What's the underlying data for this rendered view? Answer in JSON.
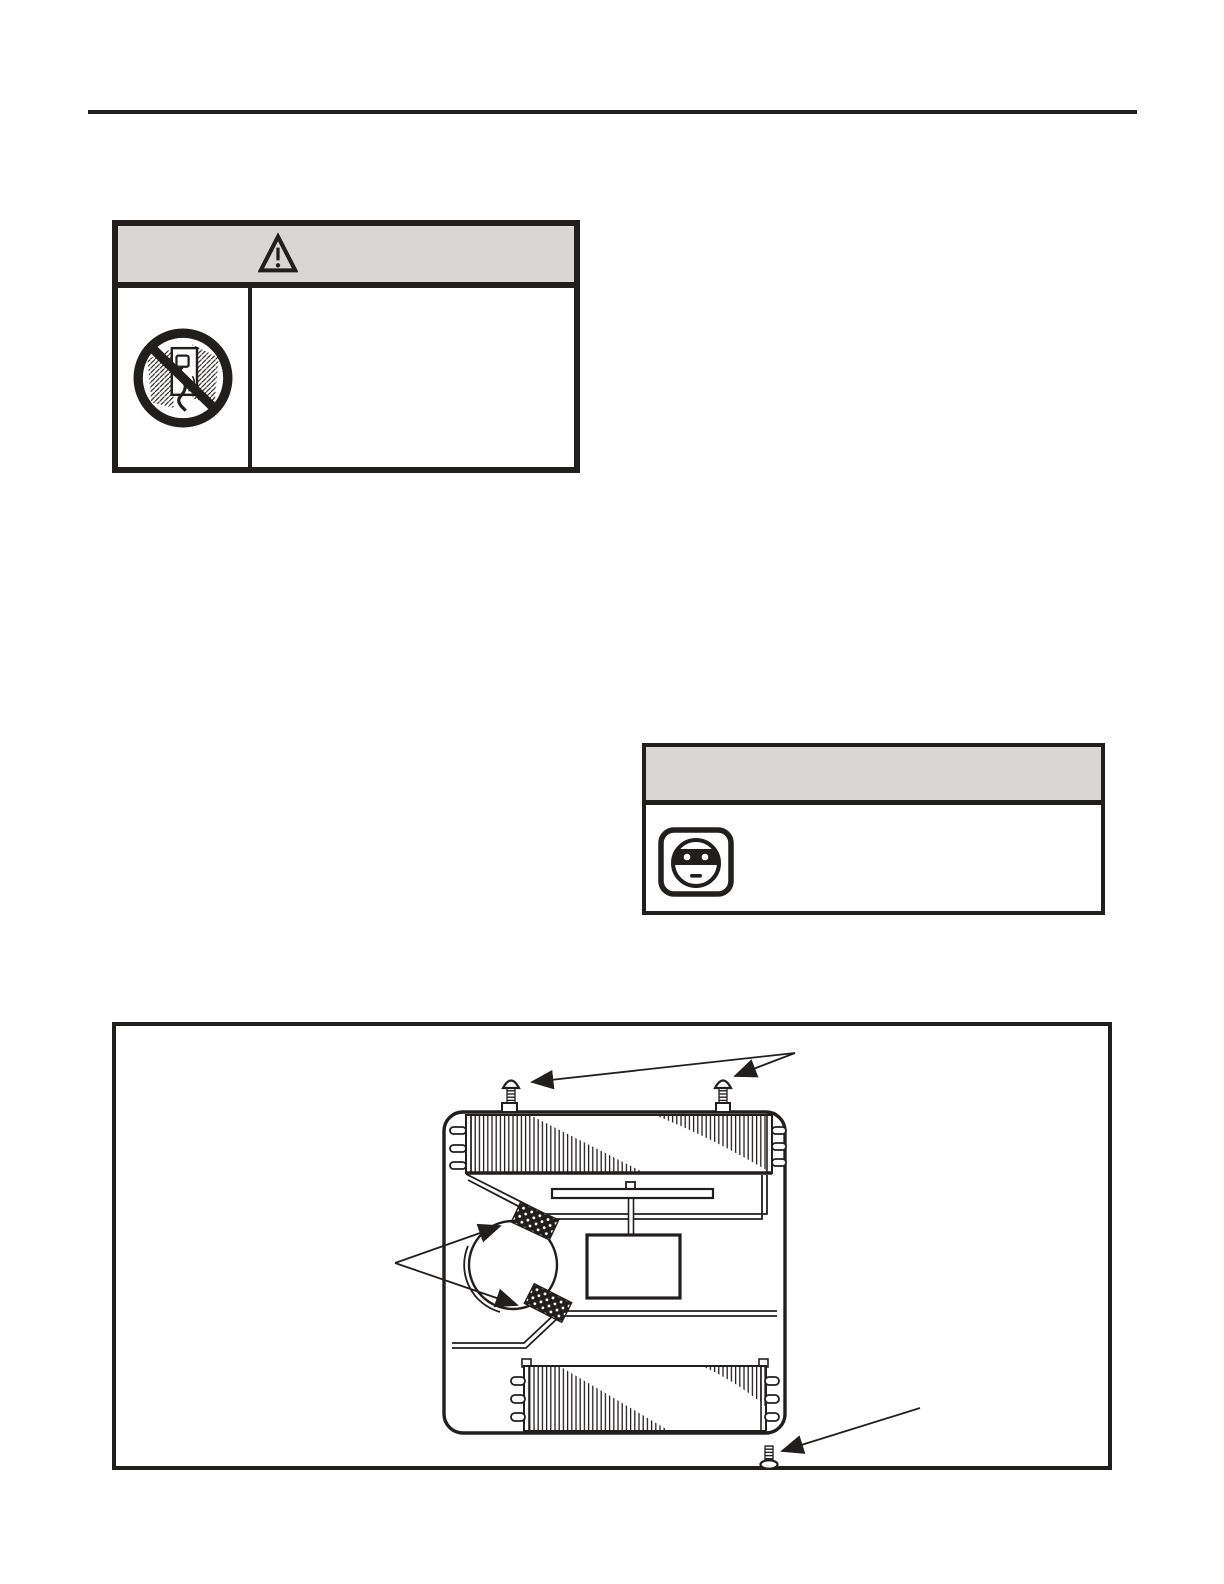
{
  "document": {
    "page_type": "illustrated-document-page",
    "colors": {
      "paper": "#ffffff",
      "ink": "#211f1e",
      "panel_header": "#d8d7d5"
    },
    "visible_text": ""
  },
  "header": {
    "rule": true
  },
  "warning_panel": {
    "header_icon": "warning-triangle-icon",
    "pictogram_icon": "no-pull-plug-icon"
  },
  "caution_panel": {
    "pictogram_icon": "power-outlet-icon"
  },
  "figure": {
    "label": "appliance-base-assembly-diagram",
    "top_screws": 2,
    "bottom_screws": 1,
    "foam_pads": 2,
    "parts": [
      "chassis",
      "condenser-coil",
      "evaporator-coil",
      "blower-circle",
      "support-bar",
      "component-box",
      "partition-panels",
      "mounting-screws",
      "foam-pads"
    ]
  }
}
